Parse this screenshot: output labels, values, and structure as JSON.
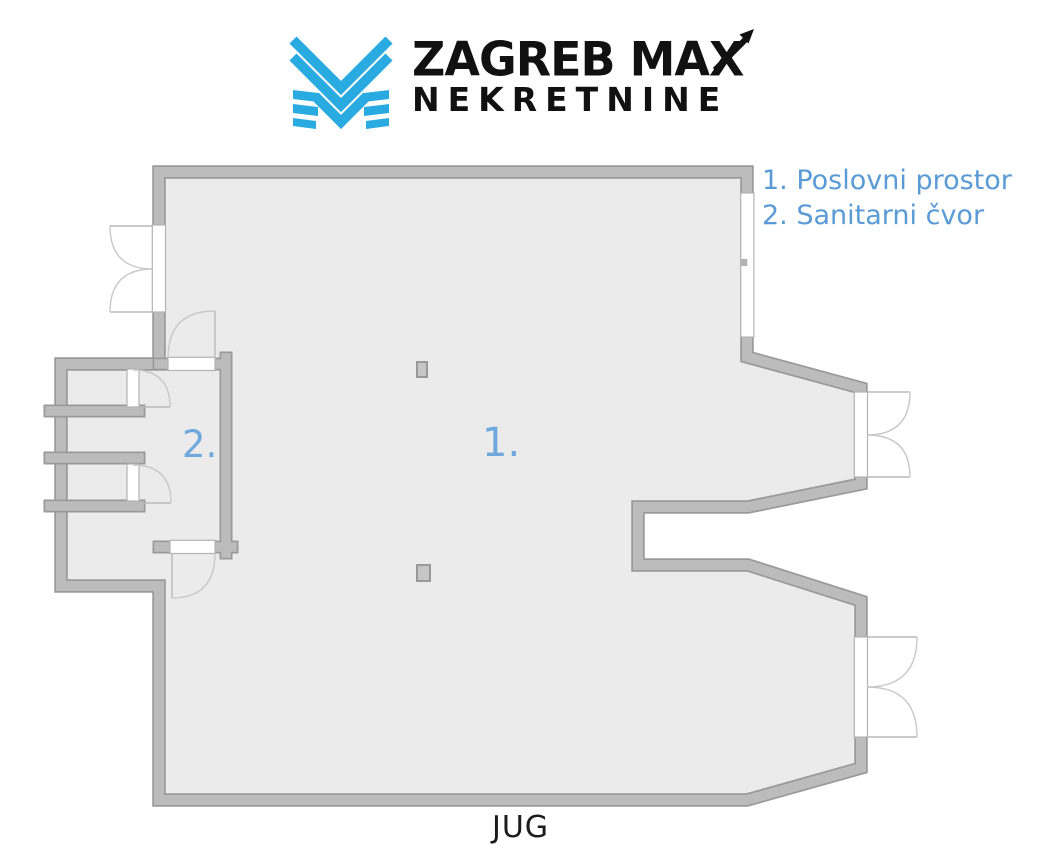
{
  "logo": {
    "title_line1": "ZAGREB MAX",
    "title_line2": "NEKRETNINE",
    "icon_name": "zagreb-max-m-icon",
    "brand_blue": "#29abe2",
    "text_color": "#111111"
  },
  "legend": {
    "text_color": "#5b9bd5",
    "items": [
      {
        "label": "1. Poslovni prostor"
      },
      {
        "label": "2. Sanitarni čvor"
      }
    ]
  },
  "floorplan": {
    "room_labels": [
      {
        "id": "1",
        "text": "1."
      },
      {
        "id": "2",
        "text": "2."
      }
    ],
    "orientation_label": "JUG",
    "colors": {
      "floor": "#ebebeb",
      "wall_fill": "#bcbcbc",
      "wall_edge": "#9a9a9a",
      "door_frame": "#ffffff",
      "door_arc": "#c9c9c9",
      "room_label_blue": "#6fa8dc",
      "pillar_fill": "#c6c6c6"
    }
  }
}
